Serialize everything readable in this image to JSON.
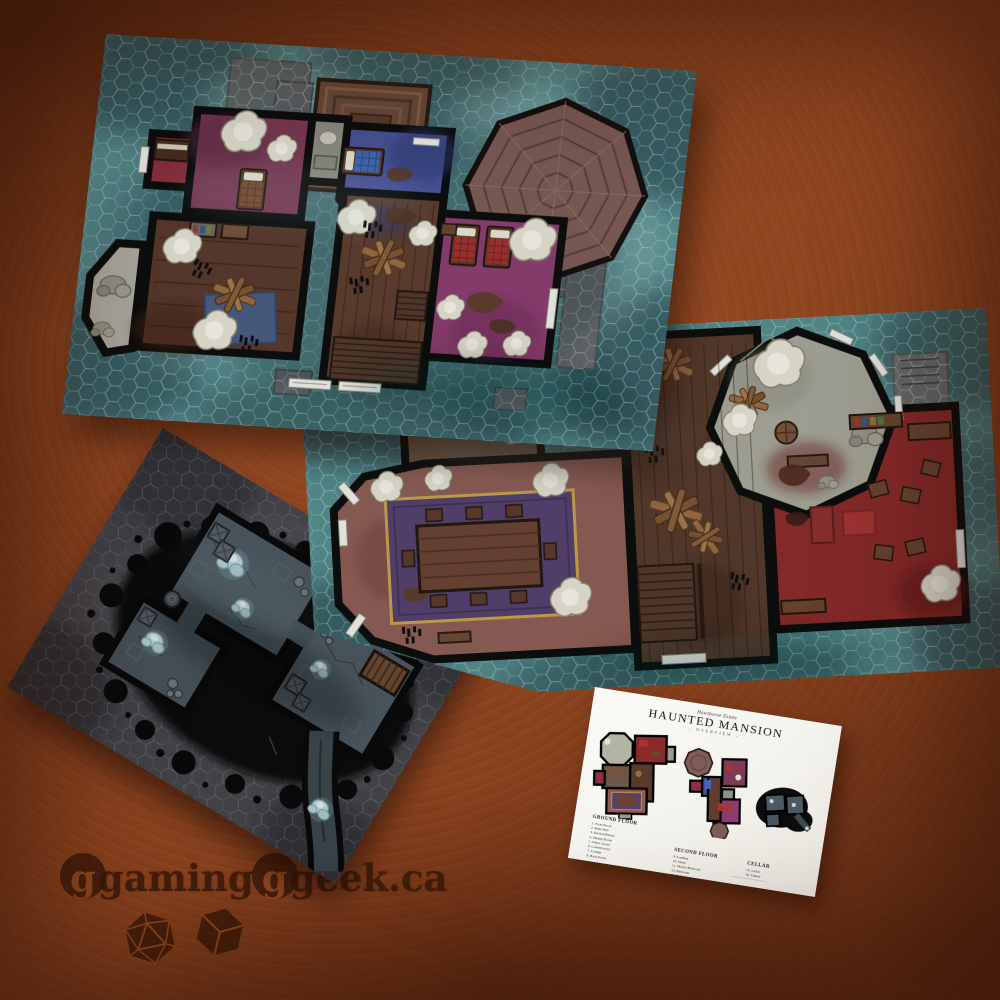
{
  "card": {
    "estate_label": "Hawthorne Estate",
    "title": "HAUNTED MANSION",
    "subtitle": "OVERVIEW",
    "sections": [
      {
        "heading": "GROUND FLOOR",
        "items": [
          "1. Front Porch",
          "2. Main Hall",
          "3. Kitchen/Pantry",
          "4. Dining Room",
          "5. Water Closet",
          "6. Conservatory",
          "7. Lounge",
          "8. Back Porch"
        ]
      },
      {
        "heading": "SECOND FLOOR",
        "items": [
          "9. Landing",
          "10. Study",
          "11. Master Bedroom",
          "12. Bedroom",
          "13. Bedroom",
          "14. Water Closet"
        ]
      },
      {
        "heading": "CELLAR",
        "items": [
          "15. Cellar",
          "16. Tunnel"
        ]
      }
    ]
  },
  "watermark": {
    "part1": "gaming",
    "part2": "geek",
    "tld": ".ca",
    "icons": [
      "d20-icon",
      "d6-icon"
    ],
    "color": "#3a1a09"
  },
  "palette": {
    "background_rust": "#8a421e",
    "map_teal": "#578d8f",
    "cellar_grey": "#47474d",
    "wall_black": "#0c0c0c",
    "card_white": "#f7f6f2",
    "accent_purple": "#7c3a56",
    "accent_magenta": "#8c3e70",
    "accent_red": "#8c2a2a",
    "accent_blue": "#4b549b"
  }
}
